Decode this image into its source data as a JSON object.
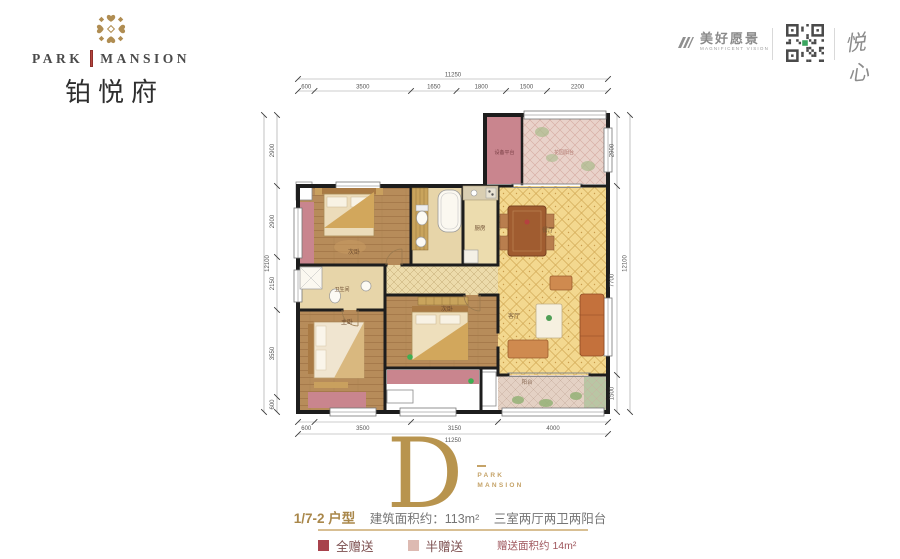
{
  "brand": {
    "en_left": "PARK",
    "en_right": "MANSION",
    "cn": "铂悦府"
  },
  "partners": {
    "vision_cn": "美好愿景",
    "vision_en": "MAGNIFICENT VISION",
    "calligraphy": "悦心"
  },
  "unit": {
    "letter": "D",
    "brand_small_1": "PARK",
    "brand_small_2": "MANSION",
    "type": "1/7-2 户型",
    "area": "建筑面积约：113m²",
    "layout": "三室两厅两卫两阳台",
    "legend": [
      {
        "label": "全赠送",
        "color": "#a8424c"
      },
      {
        "label": "半赠送",
        "color": "#ddbab2"
      }
    ],
    "bonus": "赠送面积约 14m²"
  },
  "floorplan": {
    "accent_gold": "#b8944e",
    "wall_color": "#1d1d1d",
    "rooms": [
      {
        "x": 237,
        "y": 47,
        "w": 35,
        "h": 67,
        "fill": "#c9858e"
      },
      {
        "x": 272,
        "y": 47,
        "w": 84,
        "h": 67,
        "fill": "#e9d2ca",
        "pattern": "diagPink"
      },
      {
        "x": 48,
        "y": 116,
        "w": 113,
        "h": 79,
        "fill": "#b78c5a",
        "pattern": "wood"
      },
      {
        "x": 161,
        "y": 116,
        "w": 52,
        "h": 79,
        "fill": "#e7d5a9"
      },
      {
        "x": 213,
        "y": 116,
        "w": 35,
        "h": 79,
        "fill": "#ecdcae"
      },
      {
        "x": 248,
        "y": 116,
        "w": 110,
        "h": 189,
        "fill": "#f3d88f",
        "pattern": "lattice"
      },
      {
        "x": 135,
        "y": 195,
        "w": 113,
        "h": 30,
        "fill": "#ecdbab",
        "pattern": "latticeSm"
      },
      {
        "x": 48,
        "y": 195,
        "w": 87,
        "h": 45,
        "fill": "#e7d5a9"
      },
      {
        "x": 48,
        "y": 240,
        "w": 87,
        "h": 102,
        "fill": "#b78c5a",
        "pattern": "wood"
      },
      {
        "x": 135,
        "y": 225,
        "w": 113,
        "h": 73,
        "fill": "#b78c5a",
        "pattern": "wood"
      },
      {
        "x": 248,
        "y": 305,
        "w": 110,
        "h": 37,
        "fill": "#e4d1c4",
        "pattern": "diagTan"
      },
      {
        "x": 334,
        "y": 307,
        "w": 22,
        "h": 33,
        "fill": "#b9c6a4",
        "pattern": "diagTan"
      },
      {
        "x": 48,
        "y": 132,
        "w": 16,
        "h": 63,
        "fill": "#c9858e"
      },
      {
        "x": 58,
        "y": 322,
        "w": 58,
        "h": 16,
        "fill": "#c9858e"
      },
      {
        "x": 137,
        "y": 300,
        "w": 92,
        "h": 14,
        "fill": "#c9858e"
      },
      {
        "x": 137,
        "y": 320,
        "w": 26,
        "h": 13,
        "fill": "#ffffff",
        "stroke": "#8a8a8a"
      },
      {
        "x": 232,
        "y": 302,
        "w": 14,
        "h": 34,
        "fill": "#ffffff",
        "stroke": "#8a8a8a"
      },
      {
        "x": 46,
        "y": 112,
        "w": 16,
        "h": 18,
        "fill": "#ffffff",
        "stroke": "#8a8a8a"
      }
    ],
    "room_labels": [
      {
        "t": "设备平台",
        "x": 254.5,
        "y": 84,
        "fs": 5,
        "c": "#7b4046"
      },
      {
        "t": "花园阳台",
        "x": 314,
        "y": 84,
        "fs": 5,
        "c": "#b0766d"
      },
      {
        "t": "次卧",
        "x": 104,
        "y": 184,
        "fs": 6,
        "c": "#6b4a2f"
      },
      {
        "t": "厨房",
        "x": 230,
        "y": 160,
        "fs": 5.5,
        "c": "#6b4a2f"
      },
      {
        "t": "餐厅",
        "x": 298,
        "y": 162,
        "fs": 6,
        "c": "#7a5a35"
      },
      {
        "t": "客厅",
        "x": 264,
        "y": 248,
        "fs": 6,
        "c": "#7a5a35"
      },
      {
        "t": "卫生间",
        "x": 92,
        "y": 221,
        "fs": 5,
        "c": "#6b4a2f"
      },
      {
        "t": "主卧",
        "x": 97,
        "y": 254,
        "fs": 6,
        "c": "#6b4a2f"
      },
      {
        "t": "次卧",
        "x": 197,
        "y": 241,
        "fs": 6,
        "c": "#6b4a2f"
      },
      {
        "t": "阳台",
        "x": 277,
        "y": 314,
        "fs": 5.5,
        "c": "#8a6a55"
      }
    ],
    "dims": [
      {
        "dir": "h",
        "line": 9,
        "bounds": [
          48,
          358
        ],
        "labels": [
          "11250"
        ],
        "off": -2.5
      },
      {
        "dir": "h",
        "line": 21,
        "bounds": [
          48,
          64.5,
          161,
          206.5,
          256,
          297,
          358
        ],
        "labels": [
          "600",
          "3500",
          "1650",
          "1800",
          "1500",
          "2200"
        ],
        "off": -2.5
      },
      {
        "dir": "h",
        "line": 352,
        "bounds": [
          48,
          64.5,
          161,
          248,
          358
        ],
        "labels": [
          "600",
          "3500",
          "3150",
          "4000"
        ],
        "off": 8
      },
      {
        "dir": "h",
        "line": 364,
        "bounds": [
          48,
          358
        ],
        "labels": [
          "11250"
        ],
        "off": 8
      },
      {
        "dir": "v",
        "line": 27,
        "bounds": [
          45,
          116,
          187,
          240,
          327,
          342
        ],
        "labels": [
          "2900",
          "2900",
          "2150",
          "3550",
          "600"
        ],
        "off": -3
      },
      {
        "dir": "v",
        "line": 14,
        "bounds": [
          45,
          342
        ],
        "labels": [
          "12100"
        ],
        "off": 5
      },
      {
        "dir": "v",
        "line": 367,
        "bounds": [
          45,
          116,
          305,
          342
        ],
        "labels": [
          "2900",
          "7700",
          "1500"
        ],
        "off": -3.5
      },
      {
        "dir": "v",
        "line": 380,
        "bounds": [
          45,
          342
        ],
        "labels": [
          "12100"
        ],
        "off": -3.5
      }
    ]
  }
}
